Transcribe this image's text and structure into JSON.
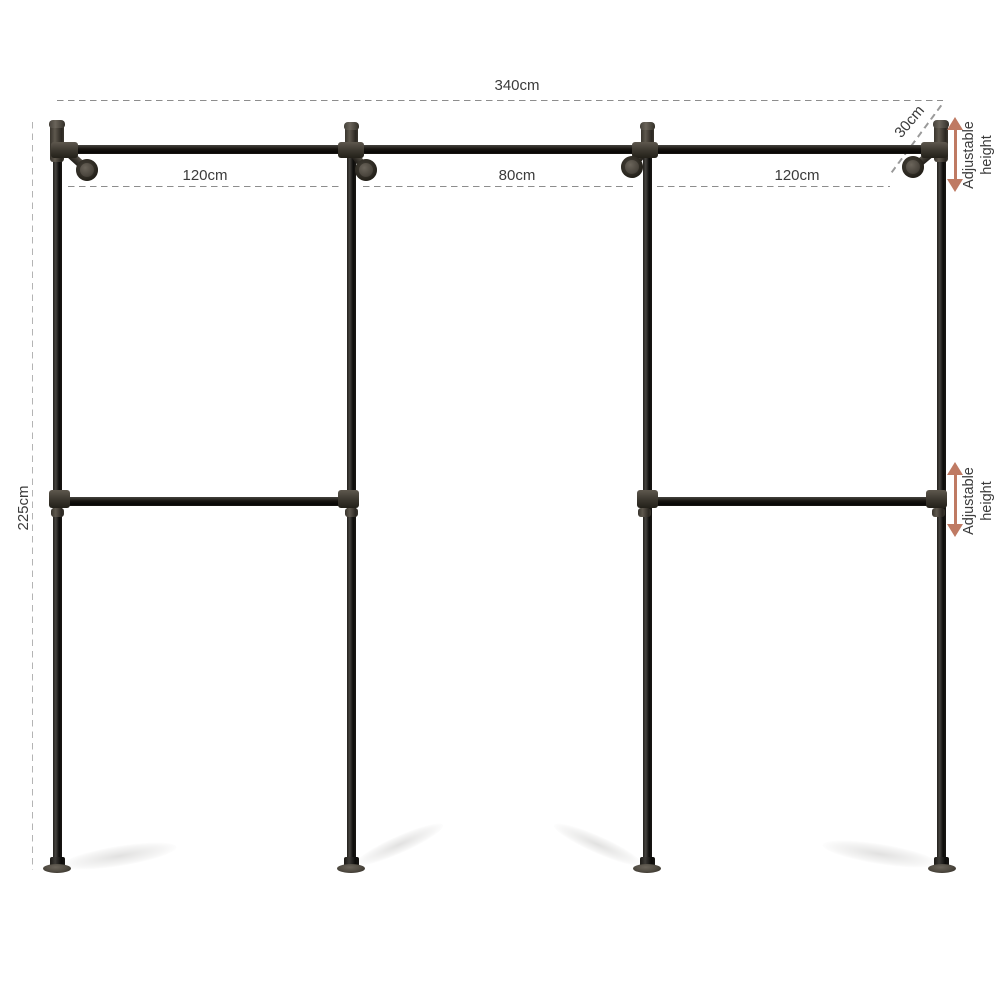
{
  "diagram": {
    "labels": {
      "total_width": "340cm",
      "section_left": "120cm",
      "section_middle": "80cm",
      "section_right": "120cm",
      "total_height": "225cm",
      "wall_depth": "30cm",
      "adjustable": "Adjustable height"
    },
    "colors": {
      "pipe": "#17150f",
      "fitting": "#534e45",
      "dimension_line": "#8d8d8d",
      "text": "#3b3b3b",
      "arrow": "#bf7a63",
      "background": "#ffffff"
    }
  }
}
